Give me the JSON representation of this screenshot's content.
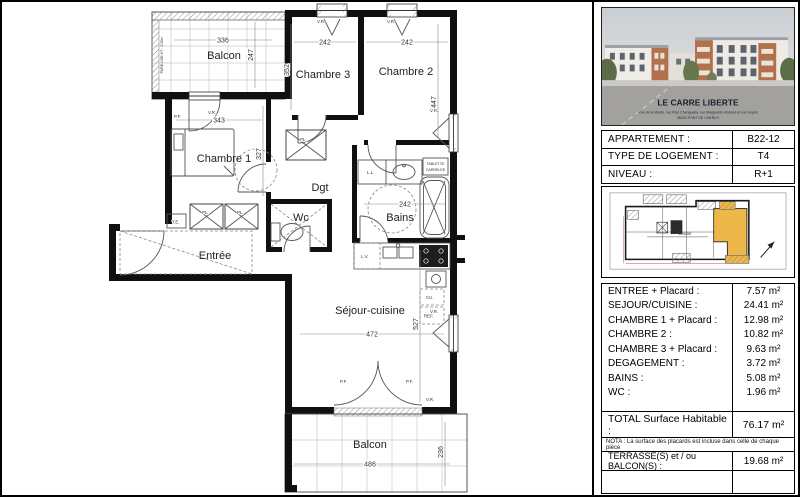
{
  "plan": {
    "labels": {
      "balcon_top": "Balcon",
      "chambre3": "Chambre 3",
      "chambre2": "Chambre 2",
      "chambre1": "Chambre 1",
      "dgt": "Dgt",
      "wc": "Wc",
      "bains": "Bains",
      "entree": "Entrée",
      "sejour": "Séjour-cuisine",
      "balcon_bottom": "Balcon"
    },
    "dims": {
      "balcon_top_w": "336",
      "balcon_top_h": "247",
      "ch3_w": "242",
      "ch3_h": "352",
      "ch2_w": "242",
      "ch2_h": "447",
      "ch1_w": "343",
      "ch1_h": "327",
      "bains_w": "242",
      "sejour_w": "472",
      "sejour_h": "527",
      "balcon_bottom_w": "486",
      "balcon_bottom_h": "236"
    },
    "annotations": {
      "pare_vue": "PARE-VUE HT : 2.00m",
      "vr": "V.R.",
      "pf": "P.F.",
      "pl": "PL.",
      "te": "T.E.",
      "ll": "L.L.",
      "lv": "L.V.",
      "cu": "CU.",
      "ref": "REF.",
      "tablette_1": "TABLETTE",
      "tablette_2": "CARRELEE"
    }
  },
  "sidebar": {
    "photo": {
      "caption": "LE CARRE LIBERTE",
      "address": "Rue de la liberté, rue Paul Chenguelia, rue Marguerite Rozand et rue Neyret",
      "city": "38230 PONT DE CHERUY"
    },
    "info": {
      "rows": [
        {
          "label": "APPARTEMENT :",
          "value": "B22-12"
        },
        {
          "label": "TYPE DE LOGEMENT :",
          "value": "T4"
        },
        {
          "label": "NIVEAU :",
          "value": "R+1"
        }
      ]
    },
    "mini_plan": {
      "highlight_color": "#edb74a",
      "corridor_label": "Couloir"
    },
    "rooms": {
      "rows": [
        {
          "label": "ENTREE + Placard :",
          "value": "7.57 m²"
        },
        {
          "label": "SEJOUR/CUISINE :",
          "value": "24.41 m²"
        },
        {
          "label": "CHAMBRE 1 + Placard :",
          "value": "12.98 m²"
        },
        {
          "label": "CHAMBRE 2 :",
          "value": "10.82 m²"
        },
        {
          "label": "CHAMBRE 3 + Placard :",
          "value": "9.63 m²"
        },
        {
          "label": "DEGAGEMENT :",
          "value": "3.72 m²"
        },
        {
          "label": "BAINS :",
          "value": "5.08 m²"
        },
        {
          "label": "WC :",
          "value": "1.96 m²"
        }
      ]
    },
    "total": {
      "label": "TOTAL Surface Habitable :",
      "value": "76.17 m²"
    },
    "nota": "NOTA : La surface des placards est incluse dans celle de chaque pièce",
    "terrasse": {
      "label": "TERRASSE(S) et / ou BALCON(S) :",
      "value": "19.68 m²"
    }
  }
}
